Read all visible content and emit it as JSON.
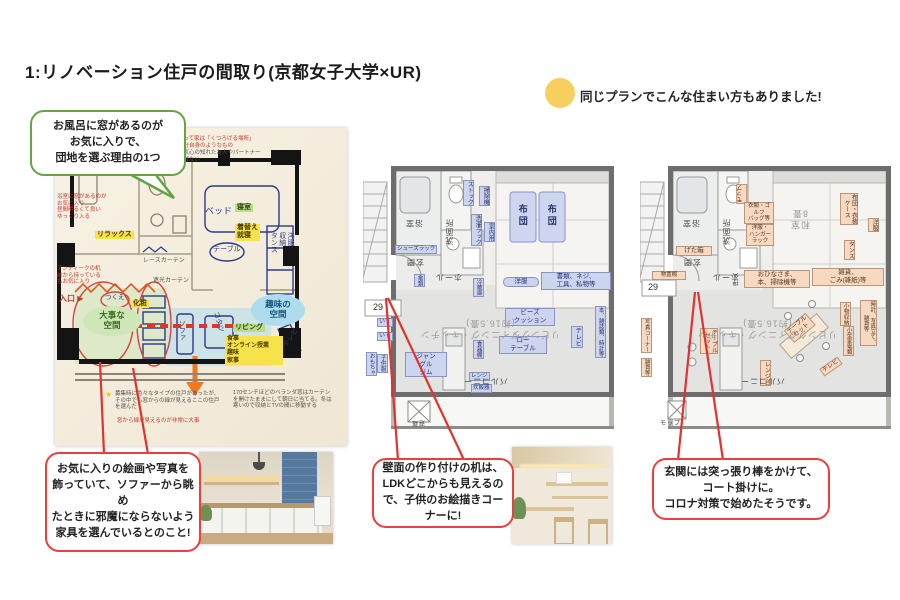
{
  "title": "1:リノベーション住戸の間取り(京都女子大学×UR)",
  "note": {
    "text": "同じプランでこんな住まい方もありました!"
  },
  "callouts": {
    "bath": "お風呂に窓があるのが\nお気に入りで、\n団地を選ぶ理由の1つ",
    "art": "お気に入りの絵画や写真を\n飾っていて、ソファーから眺め\nたときに邪魔にならないよう\n家具を選んでいるとのこと!",
    "desk": "壁面の作り付けの机は、\nLDKどこからも見えるの\nで、子供のお絵描きコー\nナーに!",
    "entrance": "玄関には突っ張り棒をかけて、\nコート掛けに。\nコロナ対策で始めたそうです。"
  },
  "colors": {
    "accent_red": "#e8403a",
    "accent_green": "#64a443",
    "note_yellow": "#f6cf5f"
  },
  "plans": {
    "plan1": {
      "labels": [
        {
          "t": "私にとって家は「くつろげる場所」\n家は自分自身のようなもの",
          "x": 112,
          "y": 8,
          "cls": "redN"
        },
        {
          "t": "家には気心の知れた友人やパートナー\nしか呼ばない",
          "x": 112,
          "y": 22,
          "cls": "darkN"
        },
        {
          "t": "浴室に窓があるのが\nお気に入り\n昼間明るくて良い\nゆっくり入る",
          "x": 2,
          "y": 66,
          "cls": "redN"
        },
        {
          "t": "リラックス",
          "x": 40,
          "y": 103,
          "cls": "hlY"
        },
        {
          "t": "アンティークの机\n前から持っている\nもお気に入り",
          "x": 2,
          "y": 138,
          "cls": "redN"
        },
        {
          "t": "入口 ▶",
          "x": 4,
          "y": 166,
          "cls": "entry"
        },
        {
          "t": "レースカーテン",
          "x": 88,
          "y": 130,
          "cls": "darkN",
          "fs": 6
        },
        {
          "t": "遮光カーテン",
          "x": 98,
          "y": 150,
          "cls": "darkN",
          "fs": 6
        },
        {
          "t": "ベッド",
          "x": 150,
          "y": 78,
          "cls": "ink",
          "fs": 9
        },
        {
          "t": "寝室",
          "x": 180,
          "y": 76,
          "cls": "hlG"
        },
        {
          "t": "着替え\n就寝",
          "x": 180,
          "y": 96,
          "cls": "hlY"
        },
        {
          "t": "テーブル",
          "x": 158,
          "y": 118,
          "cls": "ink",
          "fs": 7
        },
        {
          "t": "洋服\n収納\nタンス",
          "x": 214,
          "y": 104,
          "cls": "ink vert",
          "fs": 7
        },
        {
          "t": "化粧",
          "x": 76,
          "y": 172,
          "cls": "hlY"
        },
        {
          "t": "つくえ",
          "x": 50,
          "y": 166,
          "cls": "ink",
          "fs": 6.5
        },
        {
          "t": "大事な\n空間",
          "x": 28,
          "y": 178,
          "w": 58,
          "h": 30,
          "cls": "ellG"
        },
        {
          "t": "趣味の\n空間",
          "x": 196,
          "y": 166,
          "w": 54,
          "h": 32,
          "cls": "ellB"
        },
        {
          "t": "リビング",
          "x": 178,
          "y": 196,
          "cls": "hlG"
        },
        {
          "t": "食事\nオンライン授業\n趣味\n家事",
          "x": 170,
          "y": 208,
          "w": 54,
          "cls": "hlY",
          "fs": 6
        },
        {
          "t": "ソファ",
          "x": 122,
          "y": 192,
          "cls": "ink vert",
          "fs": 7
        },
        {
          "t": "コタツ",
          "x": 152,
          "y": 190,
          "cls": "ink",
          "fs": 7,
          "rot": 75
        },
        {
          "t": "テレビ",
          "x": 226,
          "y": 206,
          "cls": "ink",
          "fs": 7,
          "rot": -55
        },
        {
          "t": "★",
          "x": 50,
          "y": 262,
          "cls": "star"
        },
        {
          "t": "募集時に色々なタイプの住戸があったが、その中でも窓からの緑が見えるここの住戸を選んだ",
          "x": 60,
          "y": 263,
          "w": 108,
          "cls": "darkN"
        },
        {
          "t": "窓から緑が見えるのが非常に大事",
          "x": 62,
          "y": 290,
          "cls": "redN"
        },
        {
          "t": "170センチほどのベランダ窓はカーテンを開けたままにして朝日に当てる。冬は寒いので収納とTVの間に移動する",
          "x": 178,
          "y": 262,
          "w": 100,
          "cls": "darkN"
        }
      ]
    },
    "plan2": {
      "labels": [
        {
          "t": "ストック",
          "x": 100,
          "y": 20,
          "cls": "cB vert",
          "fs": 6
        },
        {
          "t": "掃除機",
          "x": 116,
          "y": 26,
          "cls": "cB vert",
          "fs": 6
        },
        {
          "t": "洗濯ラック",
          "x": 108,
          "y": 54,
          "cls": "cB vert",
          "fs": 6
        },
        {
          "t": "室内用",
          "x": 121,
          "y": 62,
          "cls": "cB vert",
          "fs": 6
        },
        {
          "t": "布団",
          "x": 154,
          "y": 44,
          "cls": "futonT vert"
        },
        {
          "t": "布団",
          "x": 183,
          "y": 44,
          "cls": "futonT vert"
        },
        {
          "t": "浴室",
          "x": 42,
          "y": 58,
          "cls": "room",
          "rot": 180
        },
        {
          "t": "洗面所",
          "x": 82,
          "y": 58,
          "cls": "room vert",
          "rot": 180
        },
        {
          "t": "シューズラック",
          "x": 32,
          "y": 85,
          "cls": "cB",
          "fs": 5.5
        },
        {
          "t": "玄関",
          "x": 43,
          "y": 97,
          "cls": "room",
          "rot": 180
        },
        {
          "t": "ホール",
          "x": 72,
          "y": 112,
          "cls": "room",
          "rot": 180
        },
        {
          "t": "傘類",
          "x": 51,
          "y": 114,
          "cls": "cB vert",
          "fs": 5.5
        },
        {
          "t": "29",
          "x": 10,
          "y": 142,
          "cls": "numbox"
        },
        {
          "t": "洋服",
          "x": 140,
          "y": 117,
          "w": 34,
          "cls": "cBpill"
        },
        {
          "t": "書類、ネジ、\n工具、私物等",
          "x": 178,
          "y": 112,
          "w": 66,
          "cls": "cB"
        },
        {
          "t": "いす",
          "x": 14,
          "y": 158,
          "cls": "cB",
          "fs": 6
        },
        {
          "t": "いす",
          "x": 14,
          "y": 172,
          "cls": "cB",
          "fs": 6
        },
        {
          "t": "おもちゃ",
          "x": 3,
          "y": 192,
          "cls": "cB vert",
          "fs": 5.5
        },
        {
          "t": "子供服",
          "x": 14,
          "y": 194,
          "cls": "cB vert",
          "fs": 5.5
        },
        {
          "t": "ジャン\nグル\nジム",
          "x": 42,
          "y": 192,
          "w": 38,
          "cls": "cB"
        },
        {
          "t": "ビーズ\nクッション",
          "x": 142,
          "y": 148,
          "w": 46,
          "cls": "cB"
        },
        {
          "t": "ロー\nテーブル",
          "x": 136,
          "y": 176,
          "w": 44,
          "cls": "cB"
        },
        {
          "t": "テレビ",
          "x": 208,
          "y": 166,
          "cls": "cB vert",
          "fs": 6.5
        },
        {
          "t": "冷蔵庫",
          "x": 110,
          "y": 118,
          "cls": "cB vert",
          "fs": 5.5
        },
        {
          "t": "食器棚",
          "x": 110,
          "y": 180,
          "cls": "cB vert",
          "fs": 5.5
        },
        {
          "t": "レンジ",
          "x": 106,
          "y": 212,
          "cls": "cB",
          "fs": 5.5
        },
        {
          "t": "炊飯器",
          "x": 108,
          "y": 224,
          "cls": "cB",
          "fs": 5.5
        },
        {
          "t": "本、雑誌類、時計等",
          "x": 232,
          "y": 146,
          "cls": "cB vert",
          "fs": 5.5
        },
        {
          "t": "リビングダイニング・キッチン\n(約16.5畳)",
          "x": 52,
          "y": 158,
          "w": 150,
          "cls": "roomBig",
          "rot": 180
        },
        {
          "t": "バルコニー",
          "x": 100,
          "y": 216,
          "cls": "room",
          "rot": 180
        },
        {
          "t": "避難",
          "x": 48,
          "y": 258,
          "cls": "room",
          "rot": 180,
          "fs": 6
        }
      ]
    },
    "plan3": {
      "labels": [
        {
          "t": "モップ",
          "x": 96,
          "y": 24,
          "cls": "cO vert",
          "rot": 180,
          "fs": 6
        },
        {
          "t": "衣類・ゴルフ\nバッグ等",
          "x": 104,
          "y": 42,
          "w": 26,
          "cls": "cO",
          "fs": 5.5
        },
        {
          "t": "洋服・\nハンガー\nラック",
          "x": 106,
          "y": 64,
          "w": 24,
          "cls": "cO",
          "fs": 5.5
        },
        {
          "t": "浴室",
          "x": 42,
          "y": 58,
          "cls": "room",
          "rot": 180
        },
        {
          "t": "洗面所",
          "x": 82,
          "y": 58,
          "cls": "room vert",
          "rot": 180
        },
        {
          "t": "げた箱",
          "x": 36,
          "y": 86,
          "w": 32,
          "cls": "cO"
        },
        {
          "t": "玄関",
          "x": 43,
          "y": 97,
          "cls": "room",
          "rot": 180
        },
        {
          "t": "物置棚",
          "x": 12,
          "y": 111,
          "w": 30,
          "cls": "cO",
          "fs": 5.5
        },
        {
          "t": "ホール",
          "x": 72,
          "y": 112,
          "cls": "room",
          "rot": 180
        },
        {
          "t": "和室\n8畳",
          "x": 150,
          "y": 48,
          "cls": "roomBig",
          "rot": 180
        },
        {
          "t": "布団・衣装\nケース",
          "x": 200,
          "y": 33,
          "cls": "cO vert",
          "fs": 6
        },
        {
          "t": "洋服",
          "x": 228,
          "y": 58,
          "cls": "cO vert",
          "fs": 6
        },
        {
          "t": "タンス",
          "x": 204,
          "y": 80,
          "cls": "cO vert",
          "fs": 6
        },
        {
          "t": "押入",
          "x": 94,
          "y": 112,
          "cls": "room vert",
          "rot": 180,
          "fs": 6
        },
        {
          "t": "おひなさま、\n本、掃除機等",
          "x": 104,
          "y": 110,
          "w": 62,
          "cls": "cO"
        },
        {
          "t": "雑貨、\nごみ(雑紙)等",
          "x": 172,
          "y": 108,
          "w": 68,
          "cls": "cO"
        },
        {
          "t": "29",
          "x": 8,
          "y": 122,
          "cls": "numbox"
        },
        {
          "t": "写真コーナー",
          "x": 1,
          "y": 158,
          "cls": "cO vert",
          "fs": 5.5
        },
        {
          "t": "雑貨等",
          "x": 1,
          "y": 198,
          "cls": "cO vert",
          "fs": 5.5
        },
        {
          "t": "テーブル\nセット",
          "x": 60,
          "y": 168,
          "cls": "cO vert",
          "fs": 6
        },
        {
          "t": "テーブル\nセット",
          "x": 146,
          "y": 160,
          "cls": "cO",
          "rot": -40,
          "fs": 6
        },
        {
          "t": "レンジ台",
          "x": 120,
          "y": 200,
          "cls": "cO vert",
          "fs": 6
        },
        {
          "t": "テレビ",
          "x": 180,
          "y": 202,
          "cls": "cO",
          "rot": -35,
          "fs": 6
        },
        {
          "t": "小物収納",
          "x": 200,
          "y": 142,
          "cls": "cO vert",
          "fs": 5.5
        },
        {
          "t": "小型家電類",
          "x": 203,
          "y": 166,
          "cls": "cO vert",
          "fs": 5.5
        },
        {
          "t": "時計、写真立て、\n雑貨等",
          "x": 220,
          "y": 140,
          "cls": "cO vert",
          "fs": 5.5
        },
        {
          "t": "リビングダイニング・キッチン\n(約16.5畳)",
          "x": 52,
          "y": 158,
          "w": 150,
          "cls": "roomBig",
          "rot": 180
        },
        {
          "t": "バルコニー",
          "x": 100,
          "y": 216,
          "cls": "room",
          "rot": 180
        },
        {
          "t": "モップ",
          "x": 20,
          "y": 261,
          "cls": "room",
          "fs": 6
        }
      ]
    }
  }
}
